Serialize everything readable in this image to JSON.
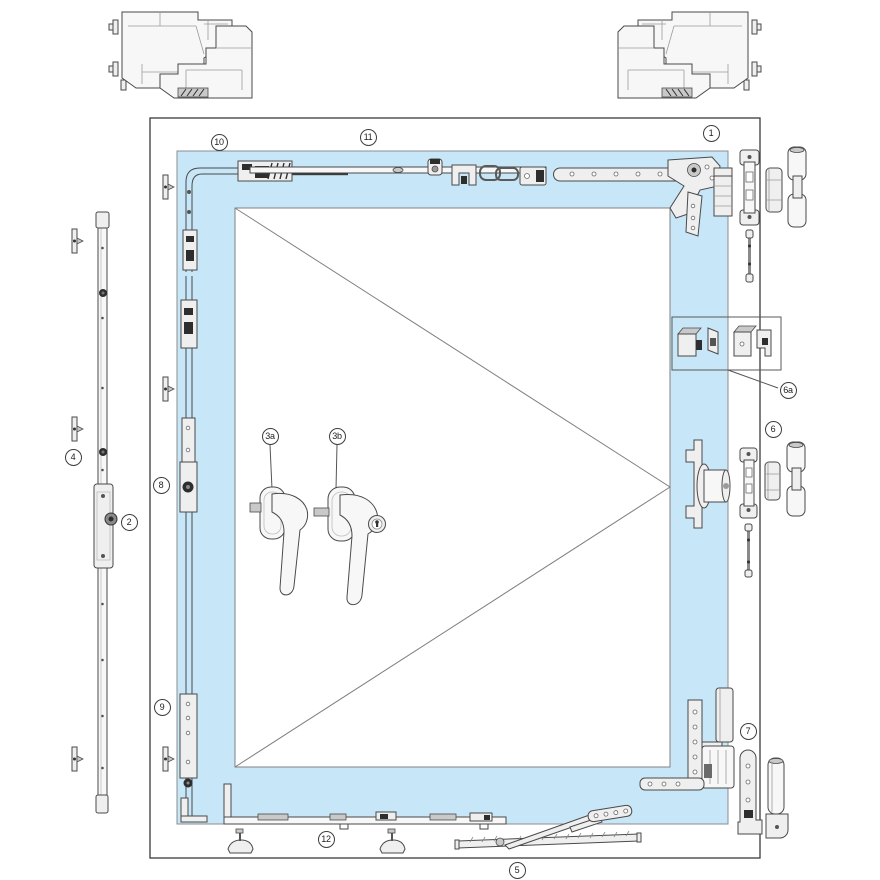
{
  "diagram": {
    "title": "tilt-turn-window-hardware-exploded-diagram",
    "colors": {
      "background": "#ffffff",
      "sash_fill": "#c7e6f7",
      "frame_line": "#3a3a3a",
      "hardware_line": "#4a4a4a",
      "dark_detail": "#2e2e2e",
      "label_border": "#3d3d3d",
      "label_text": "#1e1e1e"
    },
    "labels": [
      {
        "id": "1",
        "text": "1",
        "x": 711,
        "y": 133
      },
      {
        "id": "2",
        "text": "2",
        "x": 129,
        "y": 522
      },
      {
        "id": "3a",
        "text": "3a",
        "x": 270,
        "y": 436
      },
      {
        "id": "3b",
        "text": "3b",
        "x": 337,
        "y": 436
      },
      {
        "id": "4",
        "text": "4",
        "x": 73,
        "y": 457
      },
      {
        "id": "5",
        "text": "5",
        "x": 517,
        "y": 870
      },
      {
        "id": "6",
        "text": "6",
        "x": 773,
        "y": 429
      },
      {
        "id": "6a",
        "text": "6a",
        "x": 788,
        "y": 390
      },
      {
        "id": "7",
        "text": "7",
        "x": 748,
        "y": 731
      },
      {
        "id": "8",
        "text": "8",
        "x": 161,
        "y": 485
      },
      {
        "id": "9",
        "text": "9",
        "x": 162,
        "y": 707
      },
      {
        "id": "10",
        "text": "10",
        "x": 219,
        "y": 142
      },
      {
        "id": "11",
        "text": "11",
        "x": 368,
        "y": 137
      },
      {
        "id": "12",
        "text": "12",
        "x": 326,
        "y": 839
      }
    ],
    "parts": [
      {
        "label": "1",
        "name": "top-stay-hinge-assembly"
      },
      {
        "label": "2",
        "name": "espagnolette-gear-bar"
      },
      {
        "label": "3a",
        "name": "window-handle"
      },
      {
        "label": "3b",
        "name": "lockable-window-handle"
      },
      {
        "label": "4",
        "name": "frame-striker-plates"
      },
      {
        "label": "5",
        "name": "scissor-stay-arm"
      },
      {
        "label": "6",
        "name": "middle-hinge-and-covers"
      },
      {
        "label": "6a",
        "name": "tilt-lock-detail-parts"
      },
      {
        "label": "7",
        "name": "bottom-corner-hinge"
      },
      {
        "label": "8",
        "name": "sash-side-lock-upper"
      },
      {
        "label": "9",
        "name": "sash-side-lock-lower"
      },
      {
        "label": "10",
        "name": "corner-drive"
      },
      {
        "label": "11",
        "name": "top-tilt-lock-bar"
      },
      {
        "label": "12",
        "name": "bottom-lock-bar"
      }
    ]
  }
}
